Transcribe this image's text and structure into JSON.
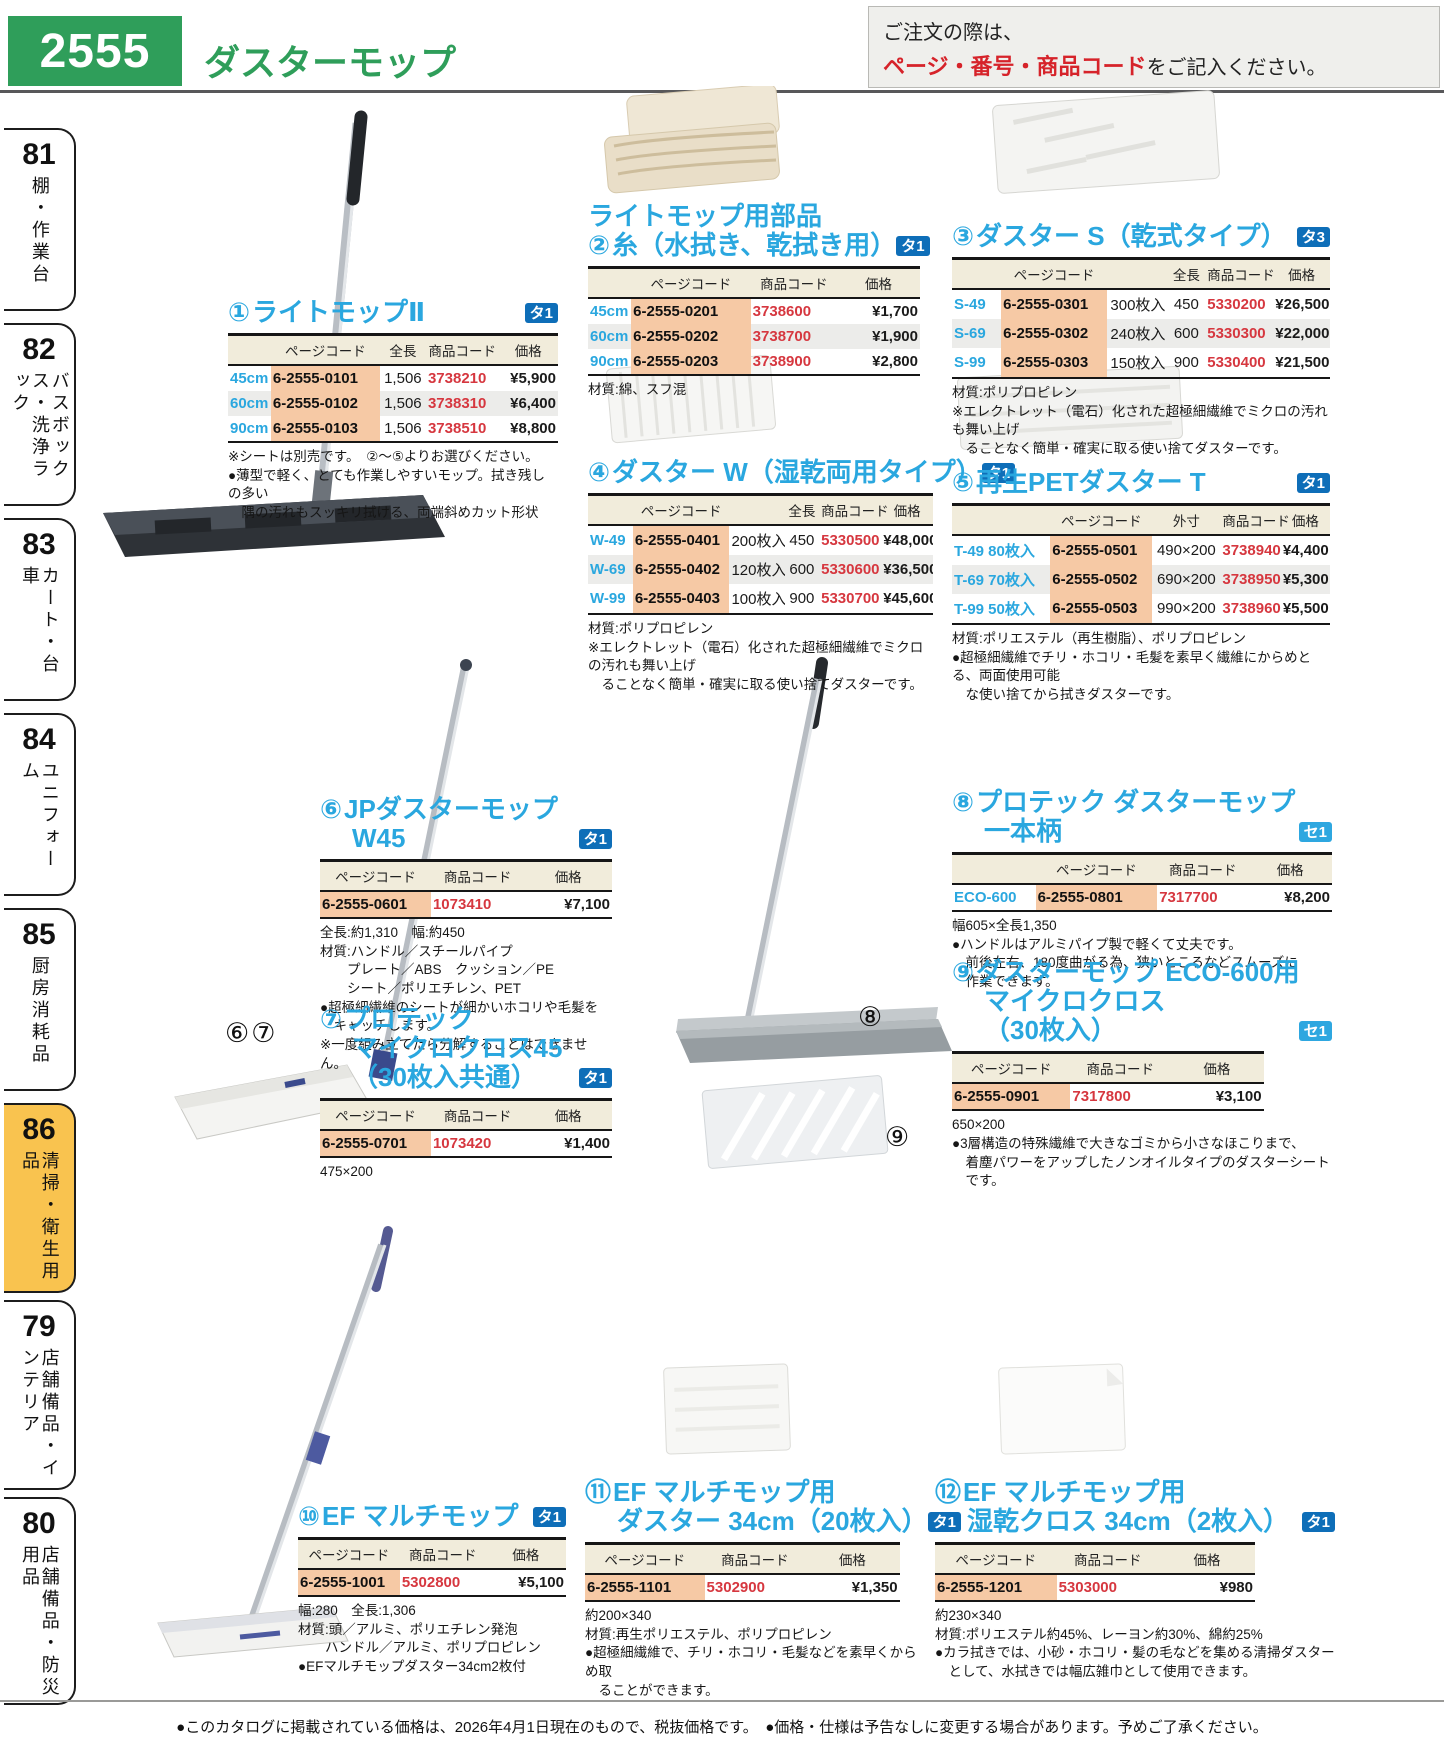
{
  "page": {
    "number": "2555",
    "title": "ダスターモップ",
    "order_note_line1": "ご注文の際は、",
    "order_note_highlight": "ページ・番号・商品コード",
    "order_note_line2": "をご記入ください。",
    "footer": "●このカタログに掲載されている価格は、2026年4月1日現在のもので、税抜価格です。　●価格・仕様は予告なしに変更する場合があります。予めご了承ください。"
  },
  "colors": {
    "brand_green": "#2f9e5a",
    "title_cyan": "#2aa7df",
    "badge_ta_blue": "#0e6eb8",
    "badge_se_blue": "#2ea7e0",
    "code_red": "#d6373f",
    "pagecode_highlight": "#f6c9a5",
    "table_header_bg": "#f1ecdb",
    "active_tab_yellow": "#f9c34f",
    "order_note_red": "#d6232a"
  },
  "sidebar": {
    "items": [
      {
        "num": "81",
        "label": "棚・作業台"
      },
      {
        "num": "82",
        "label": "バスボックス・洗浄ラック"
      },
      {
        "num": "83",
        "label": "カート・台車"
      },
      {
        "num": "84",
        "label": "ユニフォーム"
      },
      {
        "num": "85",
        "label": "厨房消耗品"
      },
      {
        "num": "86",
        "label": "清掃・衛生用品"
      },
      {
        "num": "79",
        "label": "店舗備品・インテリア"
      },
      {
        "num": "80",
        "label": "店舗備品・防災用品"
      }
    ]
  },
  "photo_labels": {
    "s6": "⑥",
    "s7": "⑦",
    "s8": "⑧",
    "s9": "⑨"
  },
  "sections": {
    "s1": {
      "num": "①",
      "title_lines": [
        "ライトモップⅡ"
      ],
      "badge": "タ1",
      "table": {
        "cols": [
          "size",
          "pagecode",
          "len",
          "code",
          "price"
        ],
        "headers": [
          "",
          "ページコード",
          "全長",
          "商品コード",
          "価格"
        ],
        "rows": [
          [
            "45cm",
            "6-2555-0101",
            "1,506",
            "3738210",
            "¥5,900"
          ],
          [
            "60cm",
            "6-2555-0102",
            "1,506",
            "3738310",
            "¥6,400"
          ],
          [
            "90cm",
            "6-2555-0103",
            "1,506",
            "3738510",
            "¥8,800"
          ]
        ]
      },
      "notes": [
        "※シートは別売です。　②～⑤よりお選びください。",
        "●薄型で軽く、とても作業しやすいモップ。拭き残しの多い",
        "　隅の汚れもスッキリ拭ける、両端斜めカット形状"
      ]
    },
    "s2": {
      "num": "②",
      "title_lines": [
        "ライトモップ用部品",
        "糸（水拭き、乾拭き用）"
      ],
      "badge": "タ1",
      "table": {
        "cols": [
          "size",
          "pagecode",
          "code",
          "price"
        ],
        "headers": [
          "",
          "ページコード",
          "商品コード",
          "価格"
        ],
        "rows": [
          [
            "45cm",
            "6-2555-0201",
            "3738600",
            "¥1,700"
          ],
          [
            "60cm",
            "6-2555-0202",
            "3738700",
            "¥1,900"
          ],
          [
            "90cm",
            "6-2555-0203",
            "3738900",
            "¥2,800"
          ]
        ]
      },
      "notes": [
        "材質:綿、スフ混"
      ]
    },
    "s3": {
      "num": "③",
      "title_lines": [
        "ダスター S（乾式タイプ）"
      ],
      "badge": "タ3",
      "table": {
        "cols": [
          "size",
          "pagecode",
          "qty",
          "len",
          "code",
          "price"
        ],
        "headers": [
          "",
          "ページコード",
          "",
          "全長",
          "商品コード",
          "価格"
        ],
        "rows": [
          [
            "S-49",
            "6-2555-0301",
            "300枚入",
            "450",
            "5330200",
            "¥26,500"
          ],
          [
            "S-69",
            "6-2555-0302",
            "240枚入",
            "600",
            "5330300",
            "¥22,000"
          ],
          [
            "S-99",
            "6-2555-0303",
            "150枚入",
            "900",
            "5330400",
            "¥21,500"
          ]
        ]
      },
      "notes": [
        "材質:ポリプロピレン",
        "※エレクトレット（電石）化された超極細繊維でミクロの汚れも舞い上げ",
        "　ることなく簡単・確実に取る使い捨てダスターです。"
      ]
    },
    "s4": {
      "num": "④",
      "title_lines": [
        "ダスター W（湿乾両用タイプ）"
      ],
      "badge": "タ1",
      "table": {
        "cols": [
          "size",
          "pagecode",
          "qty",
          "len",
          "code",
          "price"
        ],
        "headers": [
          "",
          "ページコード",
          "",
          "全長",
          "商品コード",
          "価格"
        ],
        "rows": [
          [
            "W-49",
            "6-2555-0401",
            "200枚入",
            "450",
            "5330500",
            "¥48,000"
          ],
          [
            "W-69",
            "6-2555-0402",
            "120枚入",
            "600",
            "5330600",
            "¥36,500"
          ],
          [
            "W-99",
            "6-2555-0403",
            "100枚入",
            "900",
            "5330700",
            "¥45,600"
          ]
        ]
      },
      "notes": [
        "材質:ポリプロピレン",
        "※エレクトレット（電石）化された超極細繊維でミクロの汚れも舞い上げ",
        "　ることなく簡単・確実に取る使い捨てダスターです。"
      ]
    },
    "s5": {
      "num": "⑤",
      "title_lines": [
        "再生PETダスター T"
      ],
      "badge": "タ1",
      "table": {
        "cols": [
          "size",
          "pagecode",
          "outer",
          "code",
          "price"
        ],
        "headers": [
          "",
          "ページコード",
          "外寸",
          "商品コード",
          "価格"
        ],
        "rows": [
          [
            "T-49 80枚入",
            "6-2555-0501",
            "490×200",
            "3738940",
            "¥4,400"
          ],
          [
            "T-69 70枚入",
            "6-2555-0502",
            "690×200",
            "3738950",
            "¥5,300"
          ],
          [
            "T-99 50枚入",
            "6-2555-0503",
            "990×200",
            "3738960",
            "¥5,500"
          ]
        ]
      },
      "notes": [
        "材質:ポリエステル（再生樹脂）、ポリプロピレン",
        "●超極細繊維でチリ・ホコリ・毛髪を素早く繊維にからめとる、両面使用可能",
        "　な使い捨てから拭きダスターです。"
      ]
    },
    "s6": {
      "num": "⑥",
      "title_lines": [
        "JPダスターモップ",
        "W45"
      ],
      "badge": "タ1",
      "table": {
        "cols": [
          "pagecode",
          "code",
          "price"
        ],
        "headers": [
          "ページコード",
          "商品コード",
          "価格"
        ],
        "rows": [
          [
            "6-2555-0601",
            "1073410",
            "¥7,100"
          ]
        ]
      },
      "notes": [
        "全長:約1,310　幅:約450",
        "材質:ハンドル／スチールパイプ",
        "　　プレート／ABS　クッション／PE",
        "　　シート／ポリエチレン、PET",
        "●超極細繊維のシートが細かいホコリや毛髪を",
        "　キャッチします。",
        "※一度組み立てたら分解することはできません。"
      ]
    },
    "s7": {
      "num": "⑦",
      "title_lines": [
        "プロテック",
        "マイクロクロス45",
        "（30枚入共通）"
      ],
      "badge": "タ1",
      "table": {
        "cols": [
          "pagecode",
          "code",
          "price"
        ],
        "headers": [
          "ページコード",
          "商品コード",
          "価格"
        ],
        "rows": [
          [
            "6-2555-0701",
            "1073420",
            "¥1,400"
          ]
        ]
      },
      "notes": [
        "475×200"
      ]
    },
    "s8": {
      "num": "⑧",
      "title_lines": [
        "プロテック ダスターモップ",
        "一本柄"
      ],
      "badge": "セ1",
      "table": {
        "cols": [
          "size",
          "pagecode",
          "code",
          "price"
        ],
        "headers": [
          "",
          "ページコード",
          "商品コード",
          "価格"
        ],
        "rows": [
          [
            "ECO-600",
            "6-2555-0801",
            "7317700",
            "¥8,200"
          ]
        ]
      },
      "notes": [
        "幅605×全長1,350",
        "●ハンドルはアルミパイプ製で軽くて丈夫です。",
        "　前後左右、180度曲がる為、狭いところなどスムーズに",
        "　作業できます。"
      ]
    },
    "s9": {
      "num": "⑨",
      "title_lines": [
        "ダスターモップ ECO-600用",
        "マイクロクロス",
        "（30枚入）"
      ],
      "badge": "セ1",
      "table": {
        "cols": [
          "pagecode",
          "code",
          "price"
        ],
        "headers": [
          "ページコード",
          "商品コード",
          "価格"
        ],
        "rows": [
          [
            "6-2555-0901",
            "7317800",
            "¥3,100"
          ]
        ]
      },
      "notes": [
        "650×200",
        "●3層構造の特殊繊維で大きなゴミから小さなほこりまで、",
        "　着塵パワーをアップしたノンオイルタイプのダスターシート",
        "　です。"
      ]
    },
    "s10": {
      "num": "⑩",
      "title_lines": [
        "EF マルチモップ"
      ],
      "badge": "タ1",
      "table": {
        "cols": [
          "pagecode",
          "code",
          "price"
        ],
        "headers": [
          "ページコード",
          "商品コード",
          "価格"
        ],
        "rows": [
          [
            "6-2555-1001",
            "5302800",
            "¥5,100"
          ]
        ]
      },
      "notes": [
        "幅:280　全長:1,306",
        "材質:頭／アルミ、ポリエチレン発泡",
        "　　ハンドル／アルミ、ポリプロピレン",
        "●EFマルチモップダスター34cm2枚付"
      ]
    },
    "s11": {
      "num": "⑪",
      "title_lines": [
        "EF マルチモップ用",
        "ダスター 34cm（20枚入）"
      ],
      "badge": "タ1",
      "table": {
        "cols": [
          "pagecode",
          "code",
          "price"
        ],
        "headers": [
          "ページコード",
          "商品コード",
          "価格"
        ],
        "rows": [
          [
            "6-2555-1101",
            "5302900",
            "¥1,350"
          ]
        ]
      },
      "notes": [
        "約200×340",
        "材質:再生ポリエステル、ポリプロピレン",
        "●超極細繊維で、チリ・ホコリ・毛髪などを素早くからめ取",
        "　ることができます。"
      ]
    },
    "s12": {
      "num": "⑫",
      "title_lines": [
        "EF マルチモップ用",
        "湿乾クロス 34cm（2枚入）"
      ],
      "badge": "タ1",
      "table": {
        "cols": [
          "pagecode",
          "code",
          "price"
        ],
        "headers": [
          "ページコード",
          "商品コード",
          "価格"
        ],
        "rows": [
          [
            "6-2555-1201",
            "5303000",
            "¥980"
          ]
        ]
      },
      "notes": [
        "約230×340",
        "材質:ポリエステル約45%、レーヨン約30%、綿約25%",
        "●カラ拭きでは、小砂・ホコリ・髪の毛などを集める清掃ダスター",
        "　として、水拭きでは幅広雑巾として使用できます。"
      ]
    }
  }
}
